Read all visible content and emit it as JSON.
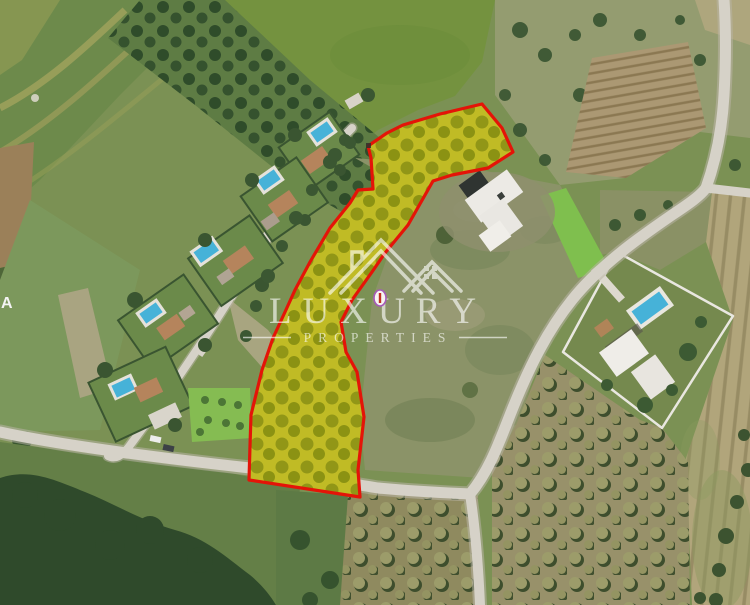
{
  "watermark": {
    "line1": "LUXURY",
    "line2": "PROPERTIES",
    "logo_icon": "double-gable-house-icon"
  },
  "map_label": {
    "text": "A"
  },
  "marker": {
    "icon": "oval-location-marker"
  },
  "colors": {
    "parcel_outline": "#e41408",
    "parcel_fill": "rgba(230,219,0,0.38)",
    "watermark": "#ffffff",
    "marker_outline": "#a65ab8",
    "marker_tick": "#c22d20",
    "pool": "#46b2d8"
  }
}
